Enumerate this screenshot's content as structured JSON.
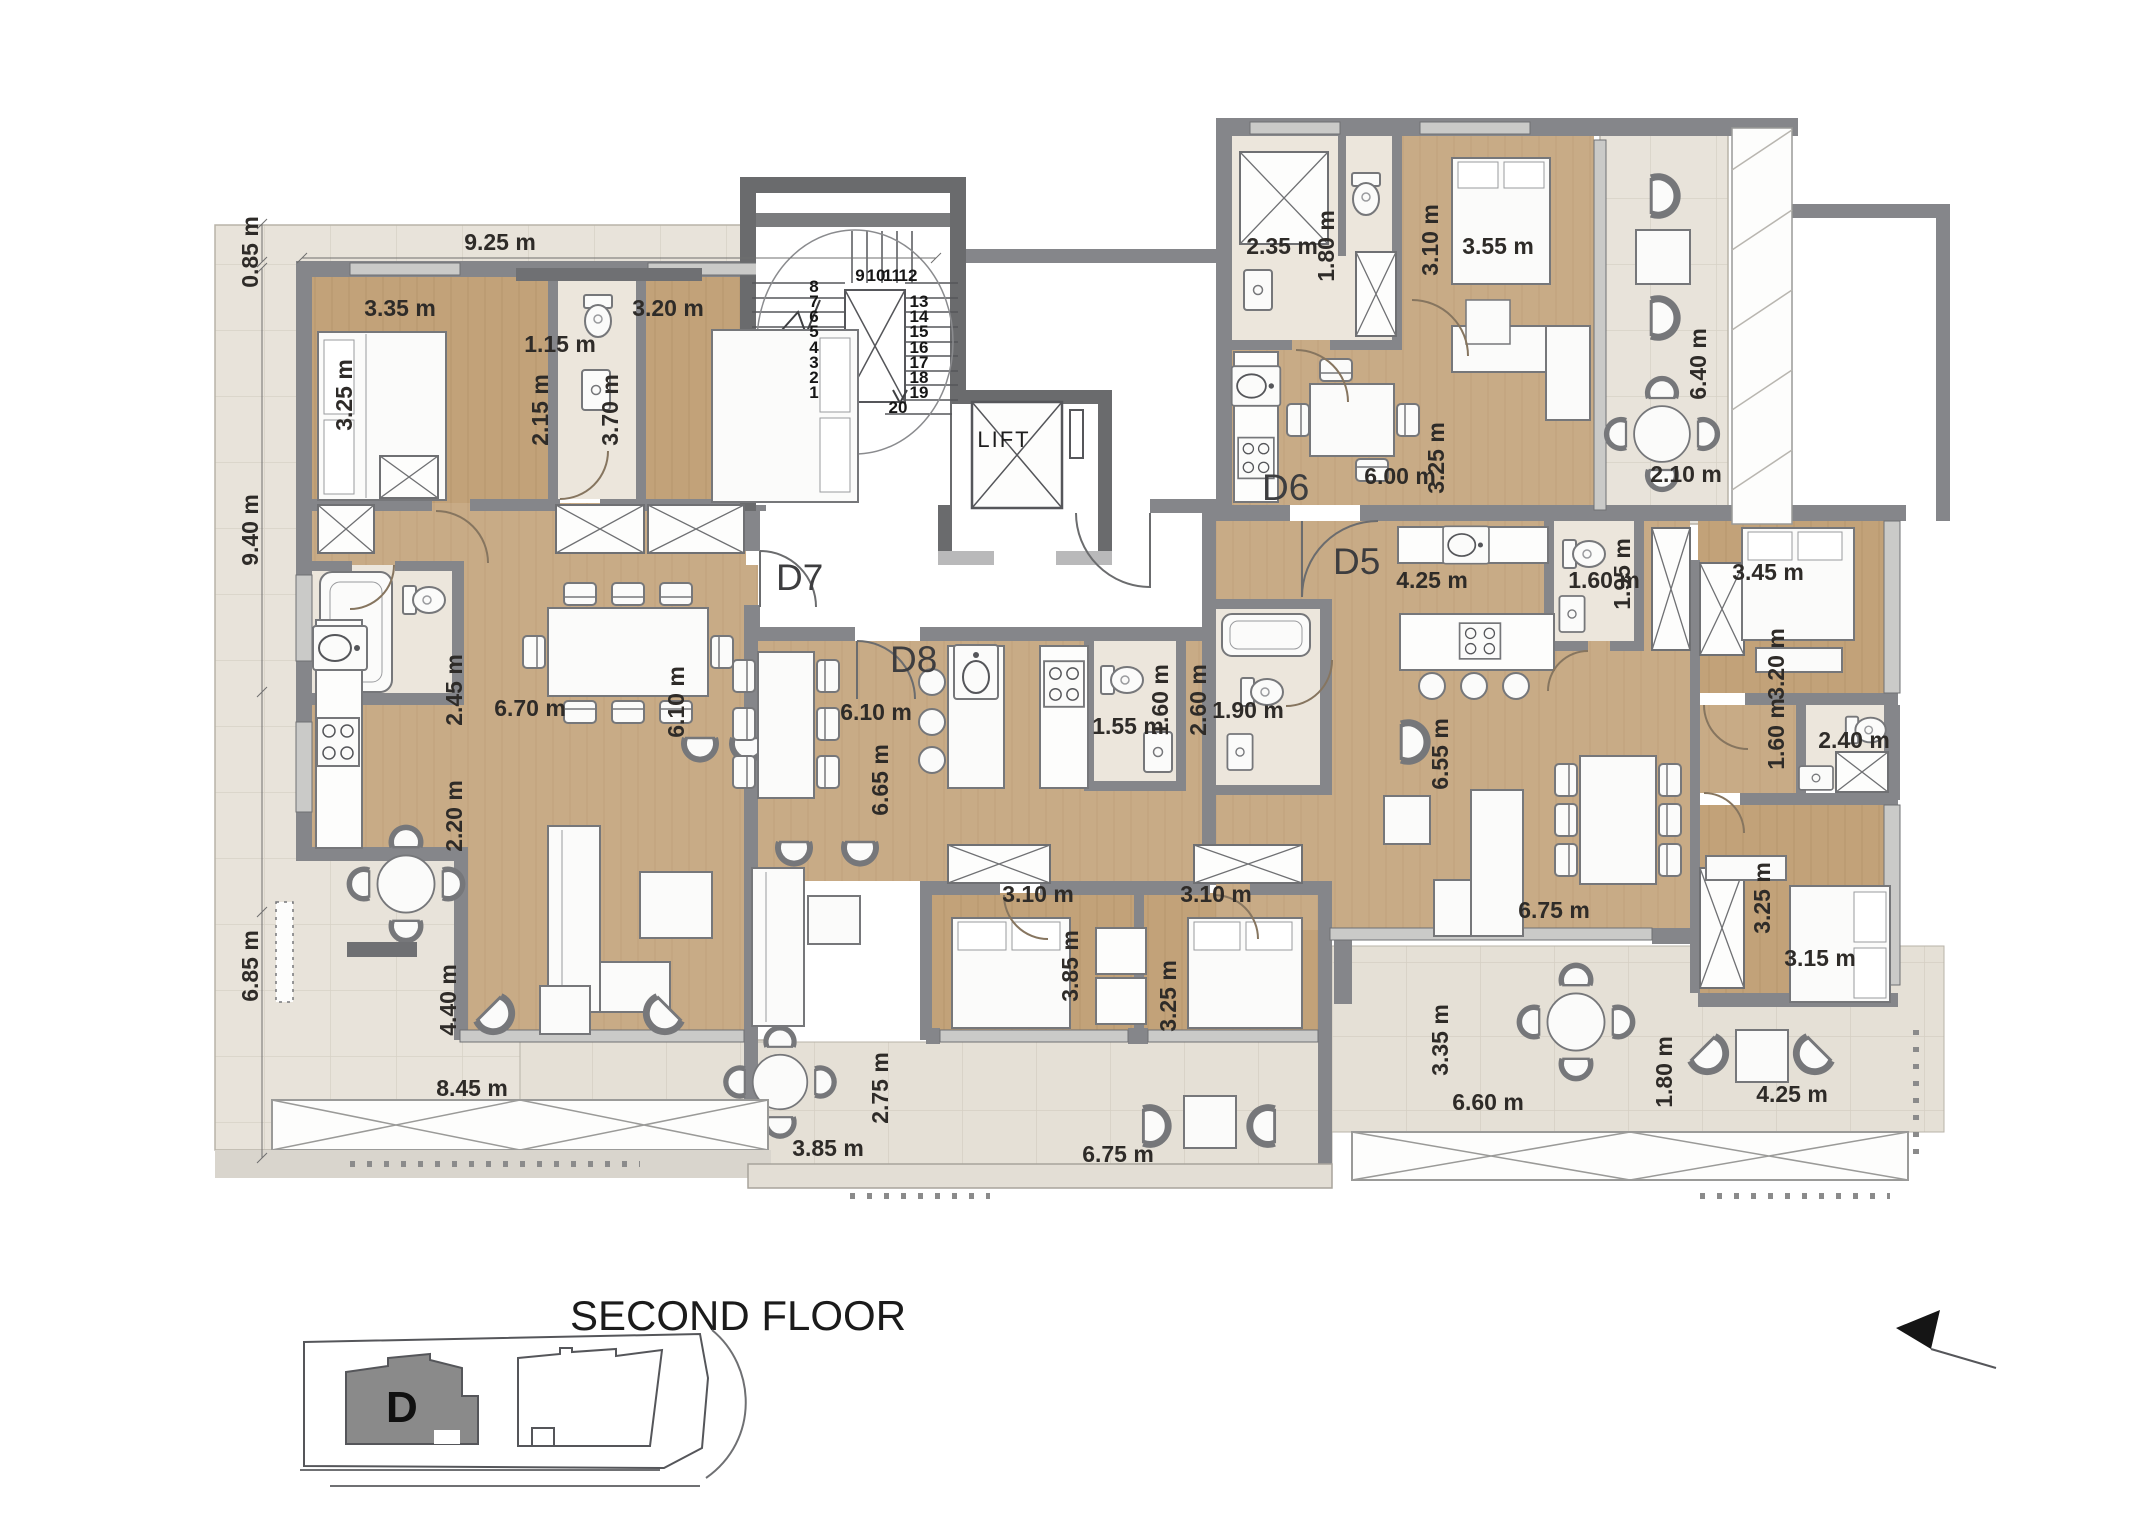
{
  "title": "SECOND FLOOR",
  "lift_label": "LIFT",
  "key_plan": {
    "building_label": "D"
  },
  "palette": {
    "wood": "#c8ab86",
    "wood_dark": "#c2a279",
    "terrace_tile": "#e8e3da",
    "balcony_tile": "#e5e0d6",
    "bath_tile": "#ece6dc",
    "wall": "#85868a",
    "wall_dark": "#6a6b6d",
    "label_text": "#2e2b28"
  },
  "apartments": [
    {
      "id": "D7",
      "x": 776,
      "y": 590
    },
    {
      "id": "D8",
      "x": 890,
      "y": 672
    },
    {
      "id": "D6",
      "x": 1262,
      "y": 500
    },
    {
      "id": "D5",
      "x": 1333,
      "y": 574
    }
  ],
  "stairs": {
    "steps": [
      {
        "n": "1",
        "x": 814,
        "y": 398
      },
      {
        "n": "2",
        "x": 814,
        "y": 383
      },
      {
        "n": "3",
        "x": 814,
        "y": 368
      },
      {
        "n": "4",
        "x": 814,
        "y": 353
      },
      {
        "n": "5",
        "x": 814,
        "y": 337
      },
      {
        "n": "6",
        "x": 814,
        "y": 322
      },
      {
        "n": "7",
        "x": 814,
        "y": 307
      },
      {
        "n": "8",
        "x": 814,
        "y": 292
      },
      {
        "n": "9",
        "x": 860,
        "y": 281
      },
      {
        "n": "10",
        "x": 876,
        "y": 281
      },
      {
        "n": "11",
        "x": 892,
        "y": 281
      },
      {
        "n": "12",
        "x": 908,
        "y": 281
      },
      {
        "n": "13",
        "x": 919,
        "y": 307
      },
      {
        "n": "14",
        "x": 919,
        "y": 322
      },
      {
        "n": "15",
        "x": 919,
        "y": 337
      },
      {
        "n": "16",
        "x": 919,
        "y": 353
      },
      {
        "n": "17",
        "x": 919,
        "y": 368
      },
      {
        "n": "18",
        "x": 919,
        "y": 383
      },
      {
        "n": "19",
        "x": 919,
        "y": 398
      },
      {
        "n": "20",
        "x": 898,
        "y": 413
      }
    ]
  },
  "dimensions": [
    {
      "text": "0.85 m",
      "x": 258,
      "y": 252,
      "rot": -90
    },
    {
      "text": "9.25 m",
      "x": 500,
      "y": 250,
      "rot": 0
    },
    {
      "text": "3.35 m",
      "x": 400,
      "y": 316,
      "rot": 0
    },
    {
      "text": "3.25 m",
      "x": 352,
      "y": 395,
      "rot": -90
    },
    {
      "text": "1.15 m",
      "x": 560,
      "y": 352,
      "rot": 0
    },
    {
      "text": "2.15 m",
      "x": 548,
      "y": 410,
      "rot": -90
    },
    {
      "text": "3.20 m",
      "x": 668,
      "y": 316,
      "rot": 0
    },
    {
      "text": "3.70 m",
      "x": 618,
      "y": 410,
      "rot": -90
    },
    {
      "text": "9.40 m",
      "x": 258,
      "y": 530,
      "rot": -90
    },
    {
      "text": "2.45 m",
      "x": 462,
      "y": 690,
      "rot": -90
    },
    {
      "text": "6.70 m",
      "x": 530,
      "y": 716,
      "rot": 0
    },
    {
      "text": "6.10 m",
      "x": 684,
      "y": 702,
      "rot": -90
    },
    {
      "text": "2.20 m",
      "x": 462,
      "y": 816,
      "rot": -90
    },
    {
      "text": "6.85 m",
      "x": 258,
      "y": 966,
      "rot": -90
    },
    {
      "text": "4.40 m",
      "x": 456,
      "y": 1000,
      "rot": -90
    },
    {
      "text": "8.45 m",
      "x": 472,
      "y": 1096,
      "rot": 0
    },
    {
      "text": "2.75 m",
      "x": 888,
      "y": 1088,
      "rot": -90
    },
    {
      "text": "3.85 m",
      "x": 828,
      "y": 1156,
      "rot": 0
    },
    {
      "text": "6.75 m",
      "x": 1118,
      "y": 1162,
      "rot": 0
    },
    {
      "text": "3.35 m",
      "x": 1448,
      "y": 1040,
      "rot": -90
    },
    {
      "text": "6.60 m",
      "x": 1488,
      "y": 1110,
      "rot": 0
    },
    {
      "text": "1.80 m",
      "x": 1672,
      "y": 1072,
      "rot": -90
    },
    {
      "text": "4.25 m",
      "x": 1792,
      "y": 1102,
      "rot": 0
    },
    {
      "text": "6.10 m",
      "x": 876,
      "y": 720,
      "rot": 0
    },
    {
      "text": "6.65 m",
      "x": 888,
      "y": 780,
      "rot": -90
    },
    {
      "text": "1.55 m",
      "x": 1128,
      "y": 734,
      "rot": 0
    },
    {
      "text": "1.60 m",
      "x": 1168,
      "y": 700,
      "rot": -90
    },
    {
      "text": "2.60 m",
      "x": 1206,
      "y": 700,
      "rot": -90
    },
    {
      "text": "1.90 m",
      "x": 1248,
      "y": 718,
      "rot": 0
    },
    {
      "text": "3.10 m",
      "x": 1038,
      "y": 902,
      "rot": 0
    },
    {
      "text": "3.10 m",
      "x": 1216,
      "y": 902,
      "rot": 0
    },
    {
      "text": "3.85 m",
      "x": 1078,
      "y": 966,
      "rot": -90
    },
    {
      "text": "3.25 m",
      "x": 1176,
      "y": 996,
      "rot": -90
    },
    {
      "text": "2.35 m",
      "x": 1282,
      "y": 254,
      "rot": 0
    },
    {
      "text": "1.80 m",
      "x": 1334,
      "y": 246,
      "rot": -90
    },
    {
      "text": "3.10 m",
      "x": 1438,
      "y": 240,
      "rot": -90
    },
    {
      "text": "3.55 m",
      "x": 1498,
      "y": 254,
      "rot": 0
    },
    {
      "text": "6.40 m",
      "x": 1706,
      "y": 364,
      "rot": -90
    },
    {
      "text": "3.25 m",
      "x": 1444,
      "y": 458,
      "rot": -90
    },
    {
      "text": "6.00 m",
      "x": 1400,
      "y": 484,
      "rot": 0
    },
    {
      "text": "2.10 m",
      "x": 1686,
      "y": 482,
      "rot": 0
    },
    {
      "text": "4.25 m",
      "x": 1432,
      "y": 588,
      "rot": 0
    },
    {
      "text": "1.60 m",
      "x": 1604,
      "y": 588,
      "rot": 0
    },
    {
      "text": "1.95 m",
      "x": 1630,
      "y": 574,
      "rot": -90
    },
    {
      "text": "3.45 m",
      "x": 1768,
      "y": 580,
      "rot": 0
    },
    {
      "text": "3.20 m",
      "x": 1784,
      "y": 664,
      "rot": -90
    },
    {
      "text": "1.60 m",
      "x": 1784,
      "y": 734,
      "rot": -90
    },
    {
      "text": "2.40 m",
      "x": 1854,
      "y": 748,
      "rot": 0
    },
    {
      "text": "6.55 m",
      "x": 1448,
      "y": 754,
      "rot": -90
    },
    {
      "text": "6.75 m",
      "x": 1554,
      "y": 918,
      "rot": 0
    },
    {
      "text": "3.25 m",
      "x": 1770,
      "y": 898,
      "rot": -90
    },
    {
      "text": "3.15 m",
      "x": 1820,
      "y": 966,
      "rot": 0
    }
  ]
}
